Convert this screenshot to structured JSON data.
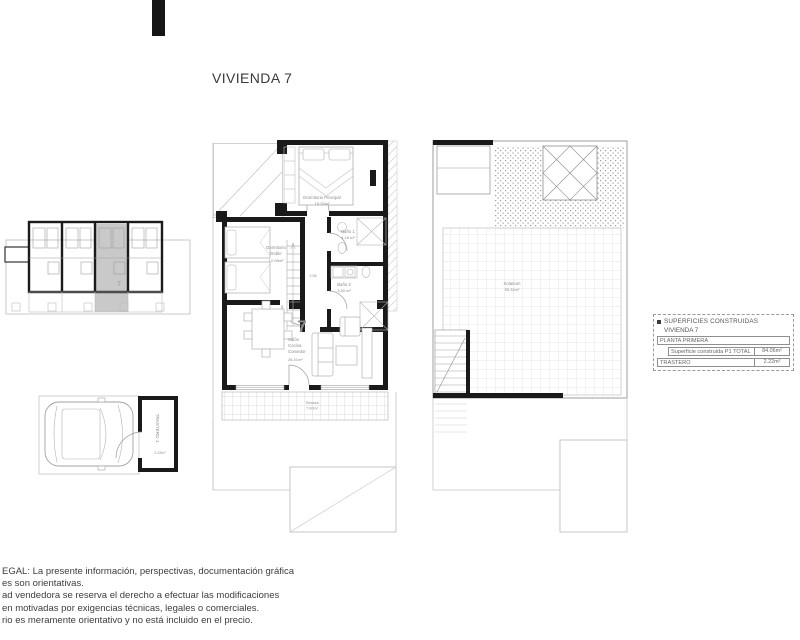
{
  "title": "VIVIENDA 7",
  "key_plan": {
    "unit_number": "7"
  },
  "garage": {
    "storage_label": "TRASTERO 1",
    "storage_area": "2.22m²"
  },
  "main_plan": {
    "unit_number": "7",
    "master_bedroom_label": "Dormitorio Principal",
    "master_bedroom_area": "15.32m²",
    "double_bedroom_line1": "Dormitorio",
    "double_bedroom_line2": "Doble",
    "double_bedroom_area": "12.08m²",
    "bath1_label": "Baño 1",
    "bath1_area": "4.18 m²",
    "bath2_label": "Baño 2",
    "bath2_area": "3.50 m²",
    "hall_dim": "2.08",
    "living_line1": "Salón",
    "living_line2": "Cocina",
    "living_line3": "Comedor",
    "living_area": "26.41m²",
    "terrace_label": "Terraza",
    "terrace_area": "7.00m²"
  },
  "roof_plan": {
    "solarium_label": "Solarium",
    "solarium_area": "55.32m²"
  },
  "legend": {
    "header": "SUPERFICIES CONSTRUIDAS",
    "subheader": "VIVIENDA 7",
    "row1_label": "PLANTA PRIMERA",
    "row2_label": "Superficie construida P1 TOTAL",
    "row2_value": "84.06m²",
    "row3_label": "TRASTERO",
    "row3_value": "2.22m²"
  },
  "legal": {
    "line1": "EGAL: La presente información, perspectivas, documentación gráfica",
    "line2": "es son orientativas.",
    "line3": "ad vendedora se reserva el derecho a efectuar las modificaciones",
    "line4": "en motivadas por exigencias técnicas, legales o comerciales.",
    "line5": "rio es meramente orientativo y no está incluido en el precio."
  },
  "colors": {
    "accent_red": "#b22626",
    "wall_black": "#1a1a1a"
  }
}
